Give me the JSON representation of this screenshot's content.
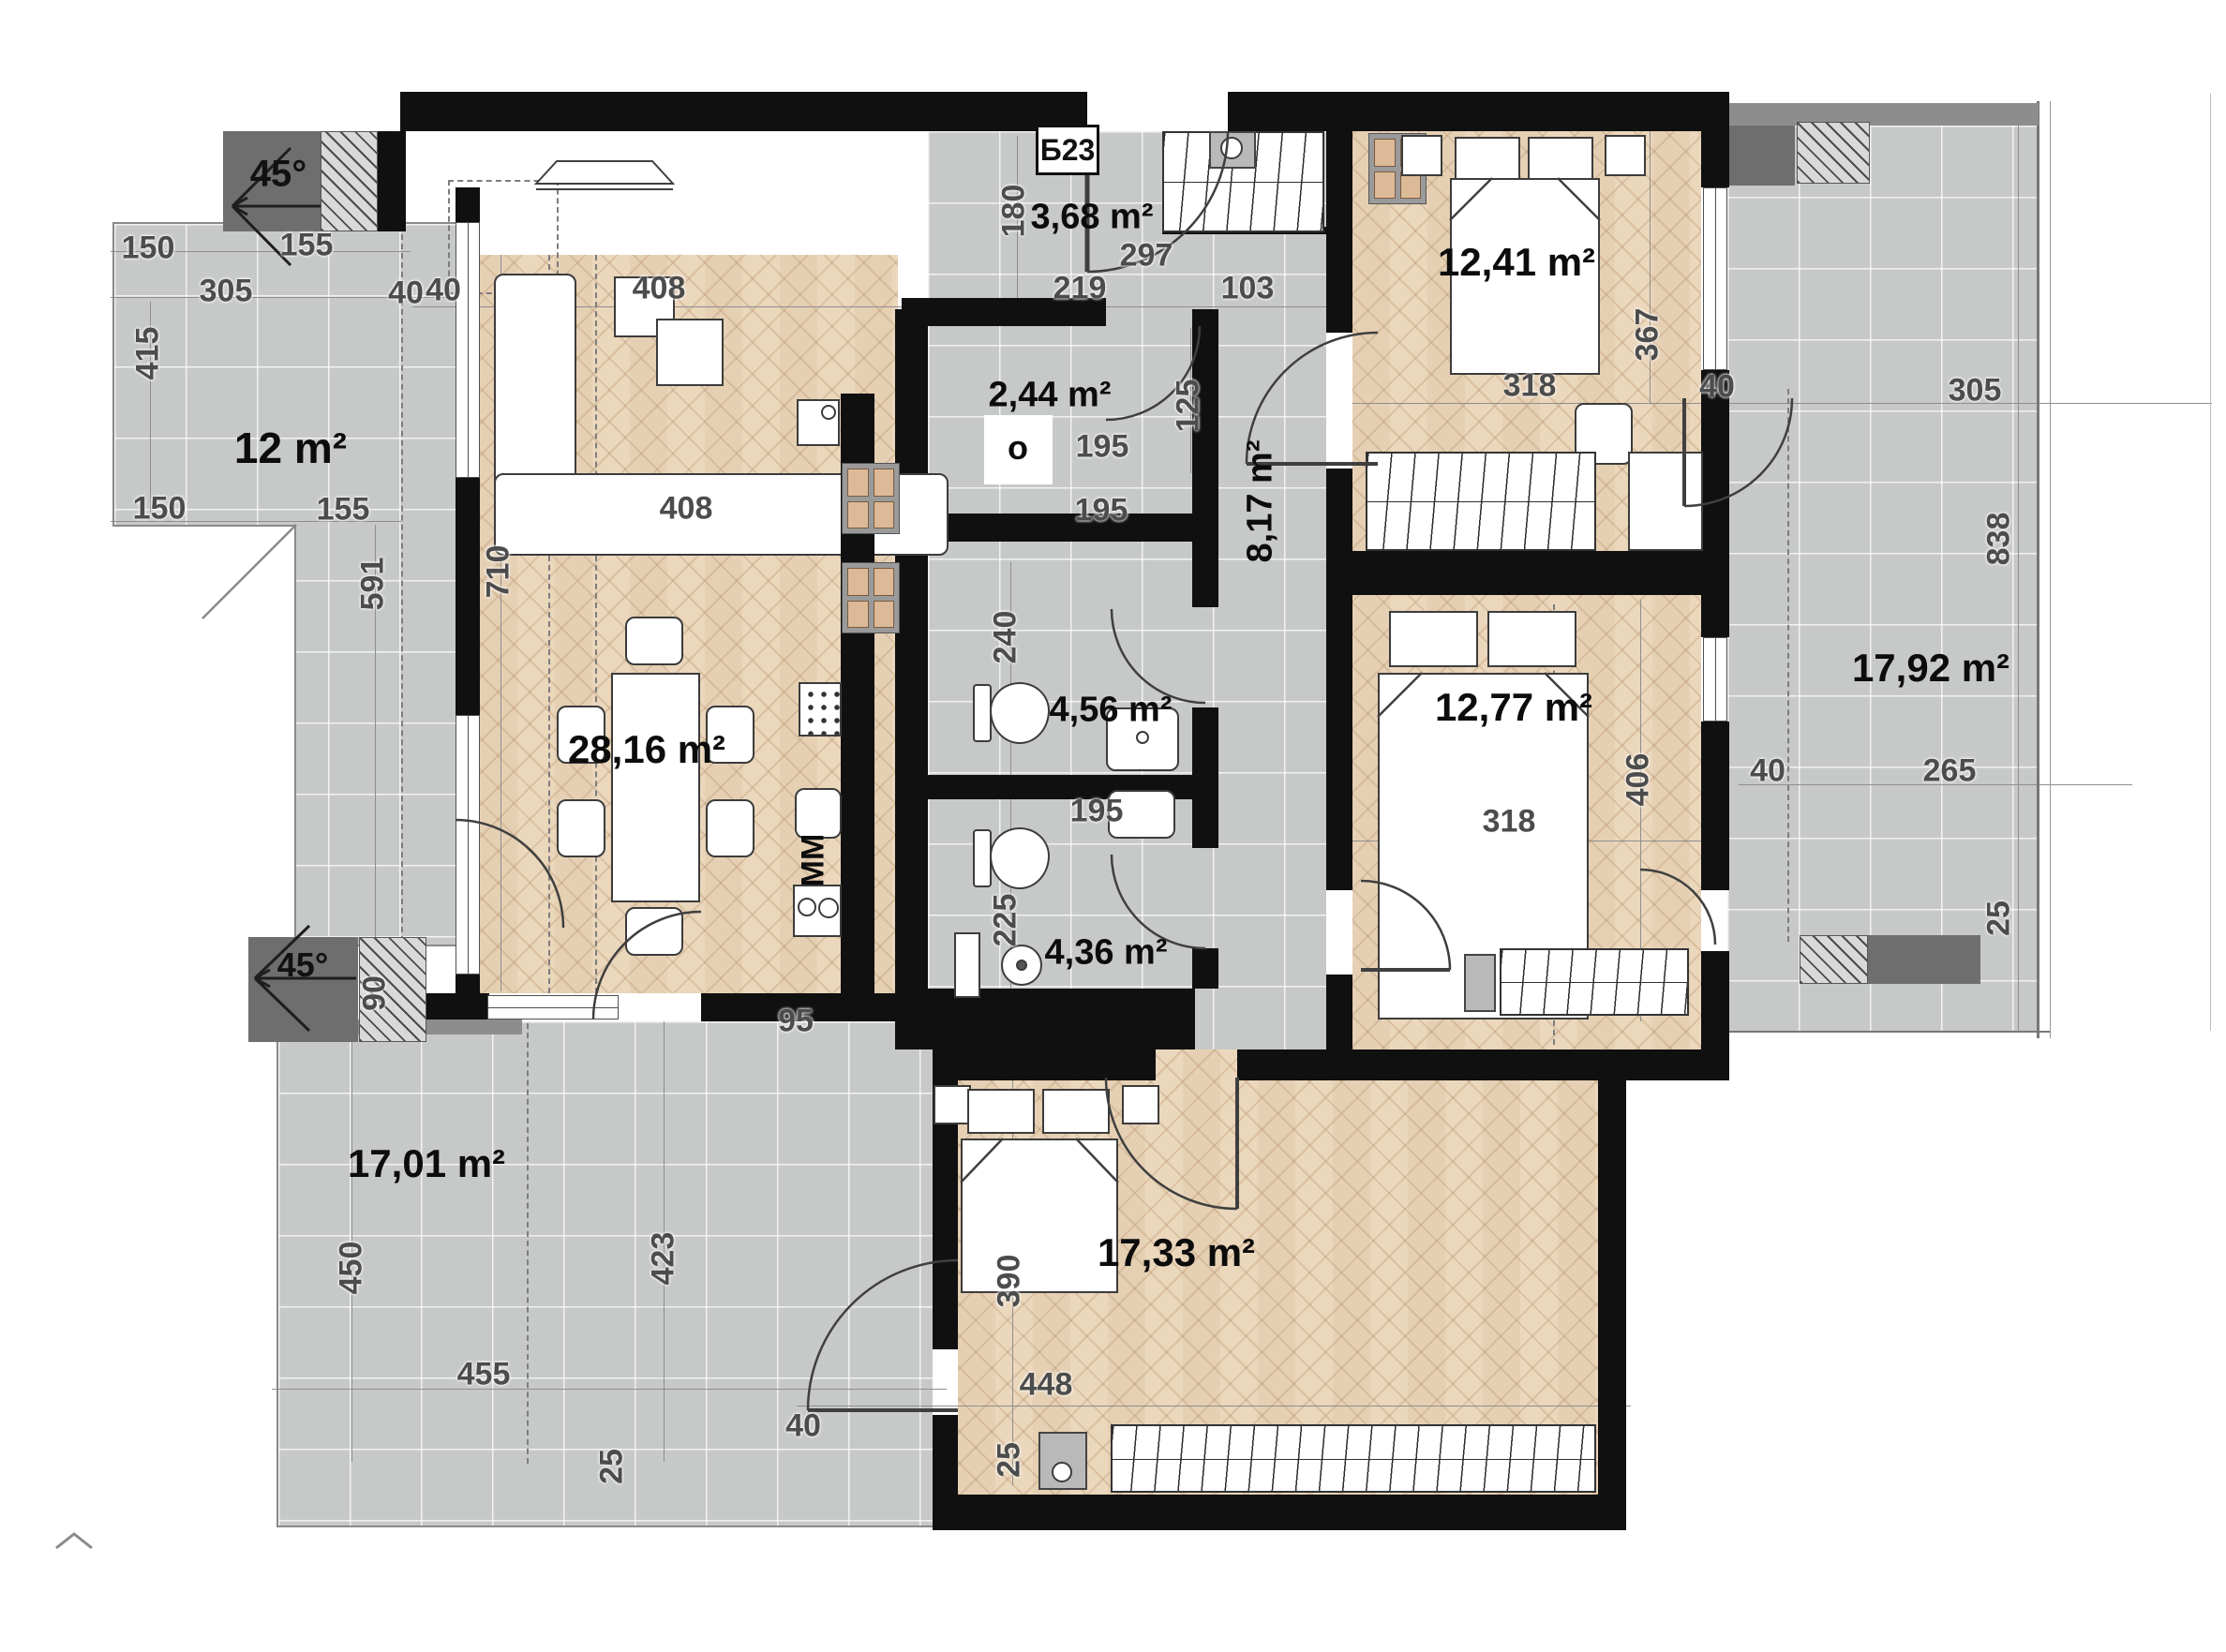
{
  "plan": {
    "apartment_code": "Б23",
    "rooms": [
      {
        "name": "terrace-left",
        "area_label": "12 m²"
      },
      {
        "name": "living-room",
        "area_label": "28,16 m²"
      },
      {
        "name": "storage",
        "area_label": "2,44 m²"
      },
      {
        "name": "entry-hall",
        "area_label": "3,68 m²"
      },
      {
        "name": "corridor",
        "area_label": "8,17 m²"
      },
      {
        "name": "bathroom-top",
        "area_label": "4,56 m²"
      },
      {
        "name": "bathroom-bottom",
        "area_label": "4,36 m²"
      },
      {
        "name": "bedroom-top",
        "area_label": "12,41 m²"
      },
      {
        "name": "bedroom-middle",
        "area_label": "12,77 m²"
      },
      {
        "name": "terrace-right",
        "area_label": "17,92 m²"
      },
      {
        "name": "terrace-bottom",
        "area_label": "17,01 m²"
      },
      {
        "name": "bedroom-bottom",
        "area_label": "17,33 m²"
      }
    ],
    "markers": {
      "roof_angle_top": "45°",
      "roof_angle_bottom": "45°",
      "washing_machine": "MM",
      "boiler": "o"
    },
    "dims": [
      "150",
      "305",
      "155",
      "40",
      "415",
      "150",
      "155",
      "591",
      "710",
      "40",
      "408",
      "408",
      "180",
      "297",
      "219",
      "103",
      "125",
      "195",
      "195",
      "240",
      "195",
      "225",
      "318",
      "367",
      "40",
      "305",
      "838",
      "265",
      "40",
      "25",
      "318",
      "406",
      "95",
      "90",
      "450",
      "455",
      "423",
      "25",
      "390",
      "448",
      "40",
      "25"
    ],
    "colors": {
      "wall": "#101010",
      "tile": "#c7c9c9",
      "wood": "#ecdac1",
      "roof_box": "#6e6e6e"
    }
  }
}
